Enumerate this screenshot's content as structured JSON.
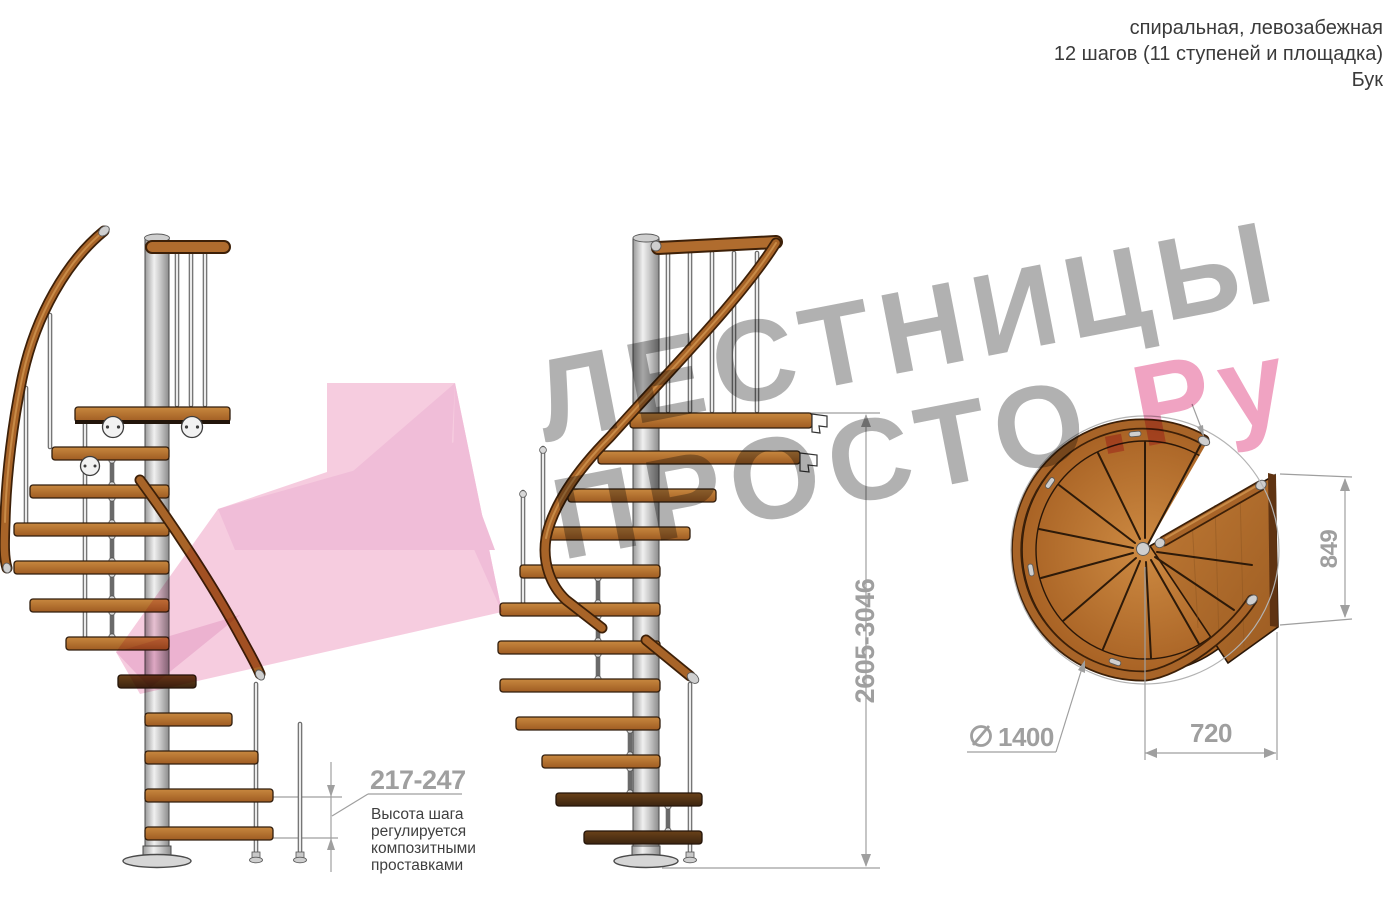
{
  "header": {
    "line1": "спиральная, левозабежная",
    "line2": "12 шагов (11 ступеней и площадка)",
    "line3": "Бук"
  },
  "watermark": {
    "word1": "ЛЕСТНИЦЫ",
    "word2": "ПРОСТО",
    "word2_suffix": ".Ру"
  },
  "dimensions": {
    "step_height_range": "217-247",
    "step_height_note_lines": [
      "Высота шага",
      "регулируется",
      "композитными",
      "проставками"
    ],
    "total_height_range": "2605-3046",
    "platform_side": "849",
    "exit_width": "720",
    "diameter_symbol": "⌀",
    "diameter_value": "1400"
  },
  "colors": {
    "dim_gray": "#9f9f9f",
    "note_text": "#3f3f3f",
    "header_text": "#3a3a3a",
    "watermark_gray": "#a9a9a9",
    "watermark_pink": "#ef99bb",
    "arrow_pink_light": "#f5c3da",
    "arrow_pink_mid": "#eeb2d1",
    "arrow_pink_deep": "#e9a5c8",
    "wood": "#a86428",
    "wood_dark": "#3d2008",
    "steel": "#cfcfcf"
  }
}
